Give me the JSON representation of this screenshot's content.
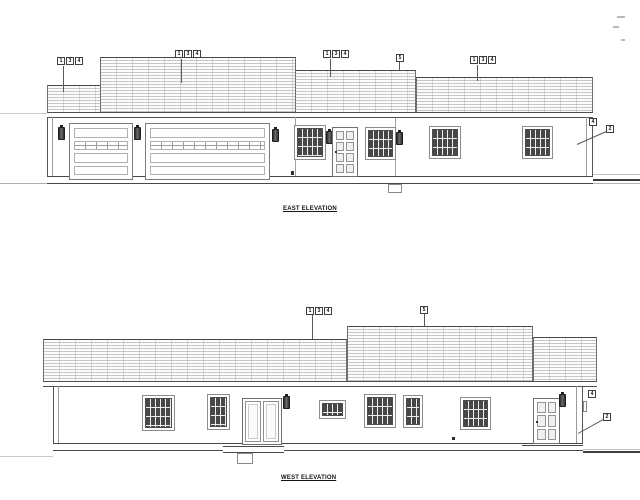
{
  "east": {
    "title": "EAST ELEVATION",
    "callouts": {
      "c1": [
        "1",
        "3",
        "4"
      ],
      "c2": [
        "1",
        "3",
        "4"
      ],
      "c3": [
        "1",
        "3",
        "4"
      ],
      "c4": [
        "5"
      ],
      "c5": [
        "1",
        "3",
        "4"
      ],
      "c6": [
        "4"
      ],
      "c7": [
        "2"
      ]
    }
  },
  "west": {
    "title": "WEST ELEVATION",
    "callouts": {
      "c1": [
        "1",
        "3",
        "4"
      ],
      "c2": [
        "5"
      ],
      "c3": [
        "4"
      ],
      "c4": [
        "2"
      ]
    }
  },
  "colors": {
    "line": "#555555",
    "roof_hatch": "#c6c6c6",
    "glazing": "#474747",
    "paper": "#ffffff"
  }
}
